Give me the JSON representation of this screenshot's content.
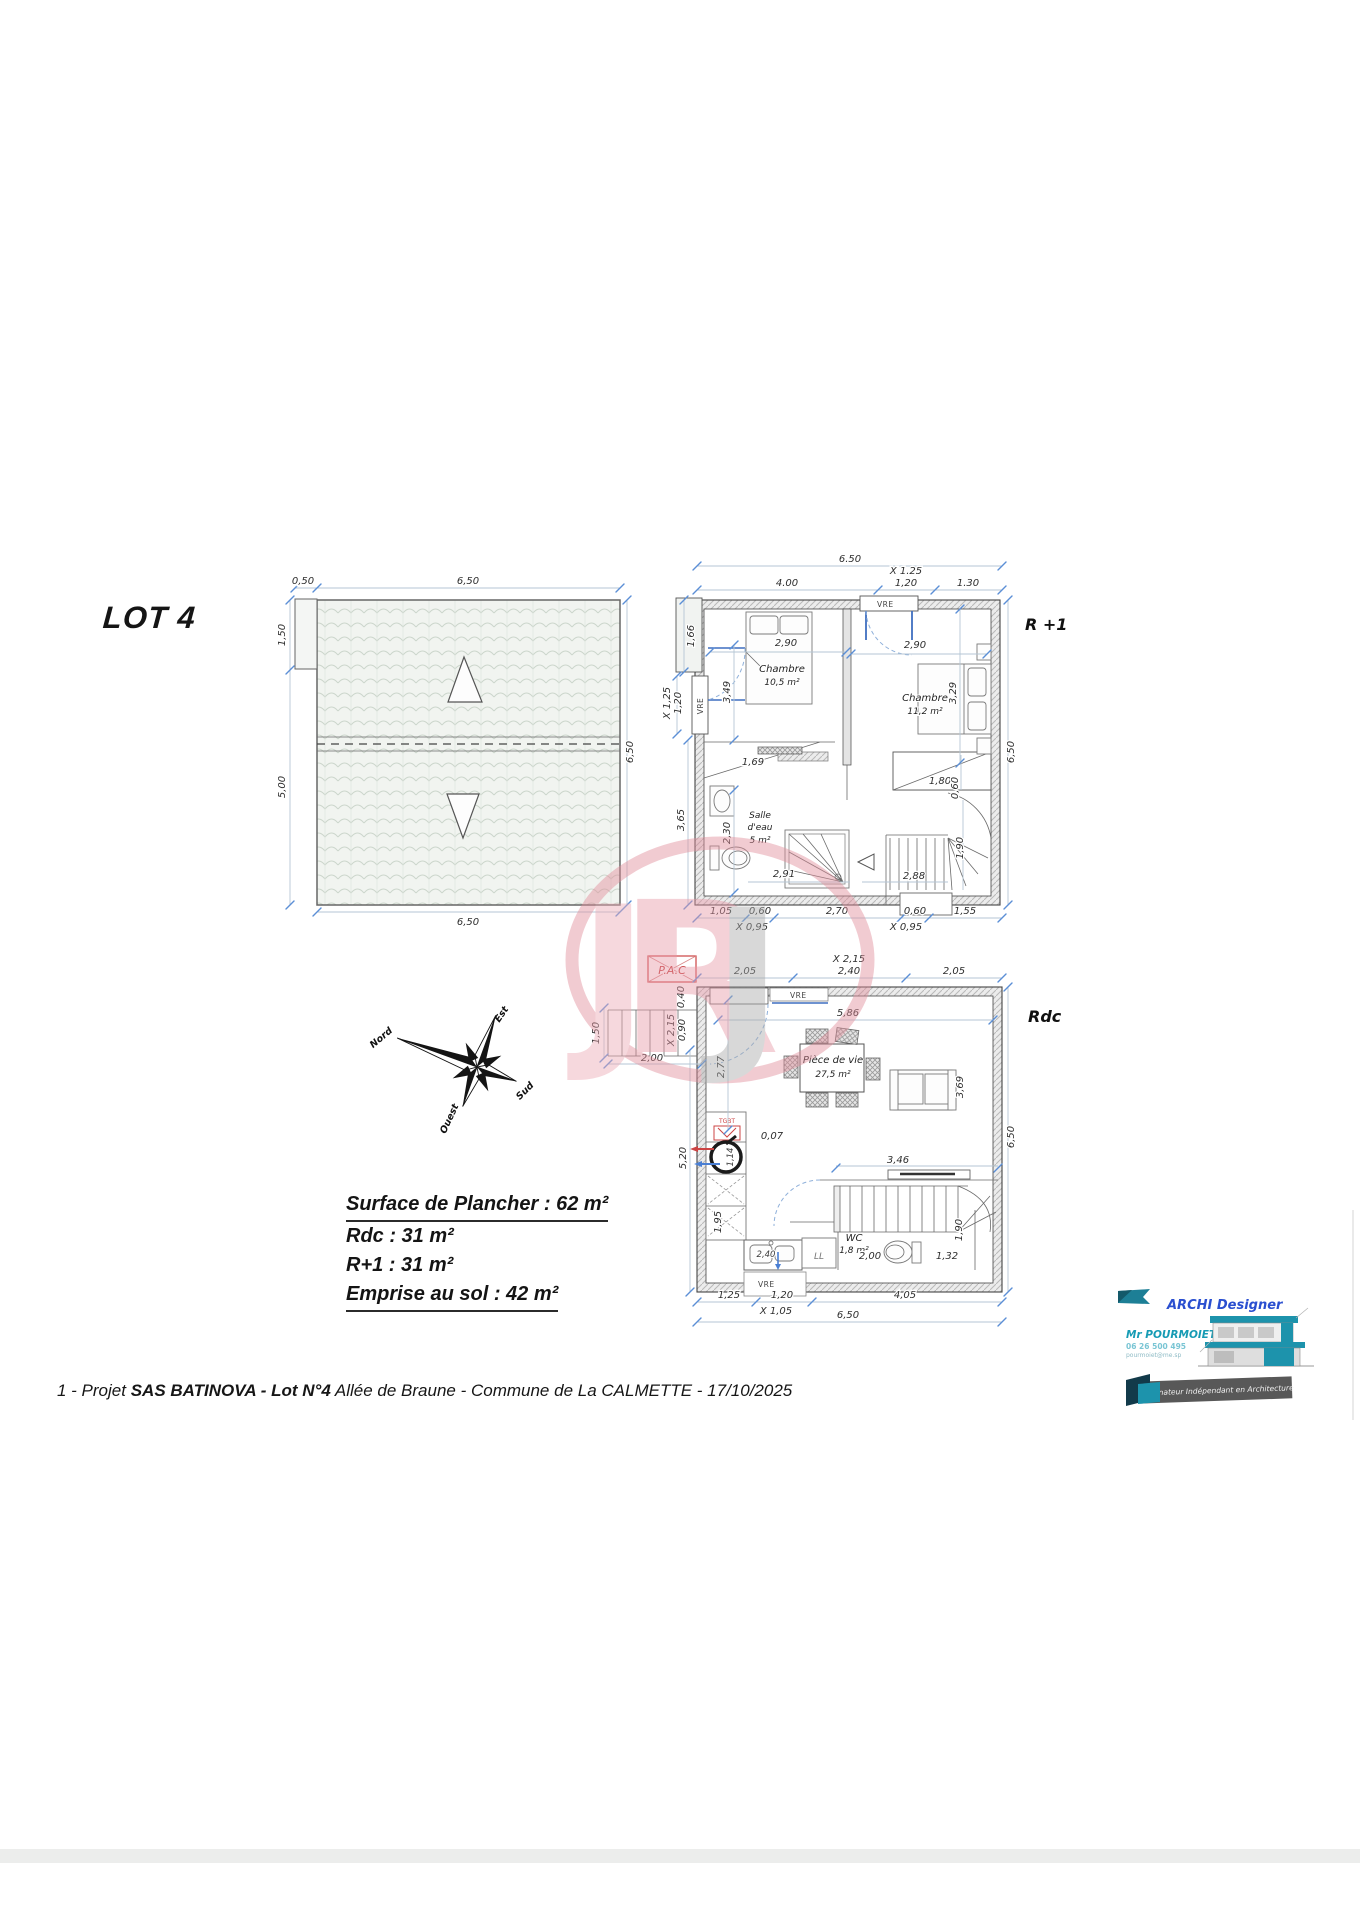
{
  "title": {
    "lot": "LOT 4"
  },
  "roof": {
    "d050": "0,50",
    "top": "6,50",
    "left1": "1,50",
    "left2": "5,00",
    "right": "6,50",
    "bottom": "6,50"
  },
  "r1": {
    "label": "R +1",
    "top": {
      "d650": "6.50",
      "d400": "4.00",
      "x125": "X 1.25",
      "d120": "1,20",
      "d130": "1.30"
    },
    "left": {
      "d166": "1,66",
      "x125": "X 1,25",
      "d120": "1,20",
      "vre": "VRE",
      "d349": "3,49",
      "d365": "3,65",
      "d230": "2,30"
    },
    "right": {
      "d650": "6,50",
      "d329": "3,29",
      "d060": "0,60",
      "d190": "1,90"
    },
    "mid": {
      "d290a": "2,90",
      "d290b": "2,90",
      "vre": "VRE",
      "d169": "1,69",
      "d291": "2,91",
      "d180": "1,80",
      "d288": "2,88"
    },
    "bottom": {
      "d105": "1,05",
      "d060a": "0,60",
      "x095a": "X 0,95",
      "d270": "2,70",
      "d060b": "0,60",
      "x095b": "X 0,95",
      "d155": "1,55"
    },
    "rooms": {
      "ch1a": "Chambre",
      "ch1b": "10,5 m²",
      "ch2a": "Chambre",
      "ch2b": "11,2 m²",
      "sdea": "Salle",
      "sdeb": "d'eau",
      "sdec": "5 m²"
    }
  },
  "rdc": {
    "label": "Rdc",
    "top": {
      "d205a": "2,05",
      "x215": "X 2,15",
      "d240": "2,40",
      "d205b": "2,05",
      "vre": "VRE",
      "d586": "5,86"
    },
    "left": {
      "d150": "1,50",
      "d200": "2,00",
      "x215": "X 2,15",
      "d090": "0,90",
      "d040": "0,40",
      "d277": "2,77",
      "d520": "5,20",
      "d195": "1,95",
      "d114": "1,14"
    },
    "right": {
      "d650": "6,50",
      "d369": "3,69",
      "d190": "1,90"
    },
    "mid": {
      "d007": "0,07",
      "d346": "3,46",
      "d200": "2,00",
      "d132": "1,32",
      "d240": "2,40",
      "ll": "LL",
      "vre": "VRE",
      "vre2": "VRE",
      "pac": "P.A.C",
      "tgbt": "TGBT"
    },
    "bottom": {
      "d125": "1,25",
      "d120": "1,20",
      "x105": "X 1,05",
      "d405": "4,05",
      "d650": "6,50"
    },
    "rooms": {
      "liva": "Pièce de vie",
      "livb": "27,5 m²",
      "wca": "WC",
      "wcb": "1,8 m²"
    }
  },
  "compass": {
    "n": "Nord",
    "e": "Est",
    "s": "Sud",
    "o": "Ouest"
  },
  "surface": {
    "l1": "Surface de Plancher : 62 m²",
    "l2": "Rdc : 31 m²",
    "l3": "R+1 : 31 m²",
    "l4": "Emprise au sol : 42 m²"
  },
  "footer": {
    "p1": "1 - Projet ",
    "p2": "SAS BATINOVA - Lot N°4",
    "p3": "  Allée de Braune - Commune de La CALMETTE - 17/10/2025"
  },
  "logo": {
    "brand": "ARCHI Designer",
    "name": "Mr POURMOIET",
    "phone": "06 26 500 495",
    "email": "pourmoiet@me.sp",
    "tagline": "Dessinateur Indépendant en Architecture"
  },
  "watermark": {
    "l1": "J",
    "l2": "R",
    "l3": "J"
  }
}
